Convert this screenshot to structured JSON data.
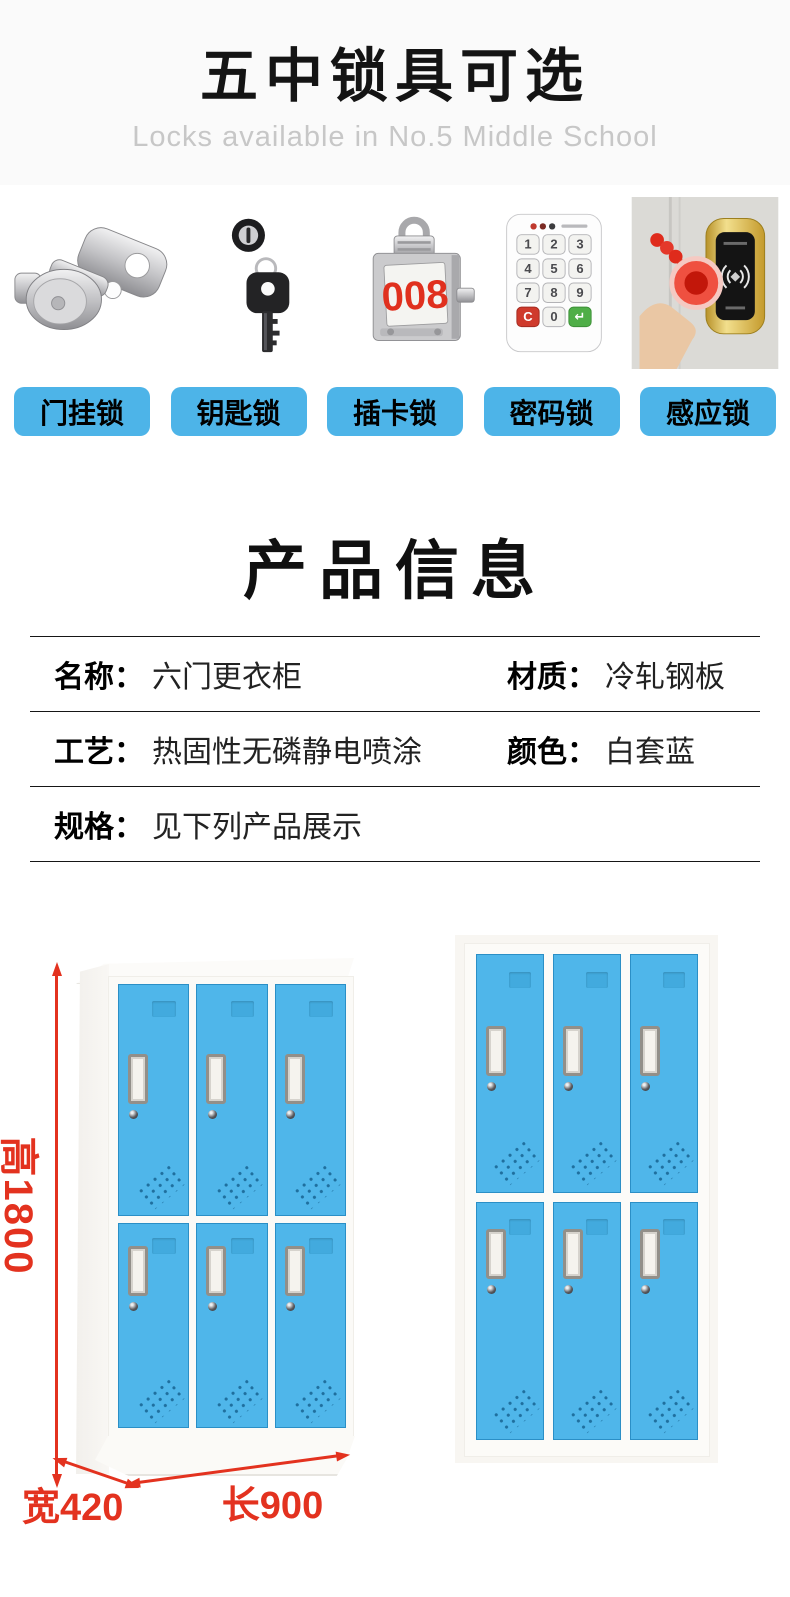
{
  "header": {
    "title": "五中锁具可选",
    "subtitle": "Locks available in No.5 Middle School"
  },
  "locks": {
    "items": [
      {
        "name": "hasp-lock",
        "label": "门挂锁"
      },
      {
        "name": "key-lock",
        "label": "钥匙锁"
      },
      {
        "name": "card-lock",
        "label": "插卡锁",
        "plate_text": "008"
      },
      {
        "name": "password-lock",
        "label": "密码锁",
        "keys": [
          "1",
          "2",
          "3",
          "4",
          "5",
          "6",
          "7",
          "8",
          "9",
          "C",
          "0",
          "↵"
        ]
      },
      {
        "name": "induction-lock",
        "label": "感应锁"
      }
    ]
  },
  "product_info": {
    "title": "产品信息",
    "rows": [
      {
        "cells": [
          {
            "label": "名称：",
            "value": "六门更衣柜"
          },
          {
            "label": "材质：",
            "value": "冷轧钢板"
          }
        ]
      },
      {
        "cells": [
          {
            "label": "工艺：",
            "value": "热固性无磷静电喷涂"
          },
          {
            "label": "颜色：",
            "value": "白套蓝"
          }
        ]
      },
      {
        "cells": [
          {
            "label": "规格：",
            "value": "见下列产品展示"
          }
        ]
      }
    ]
  },
  "showcase": {
    "doors_per_locker": 6,
    "dim_height": "高1800",
    "dim_width": "宽420",
    "dim_length": "长900"
  },
  "colors": {
    "accent_blue": "#4db4e8",
    "door_blue": "#4fb6ea",
    "dimension_red": "#e3321f",
    "plate_red": "#e0301e"
  }
}
